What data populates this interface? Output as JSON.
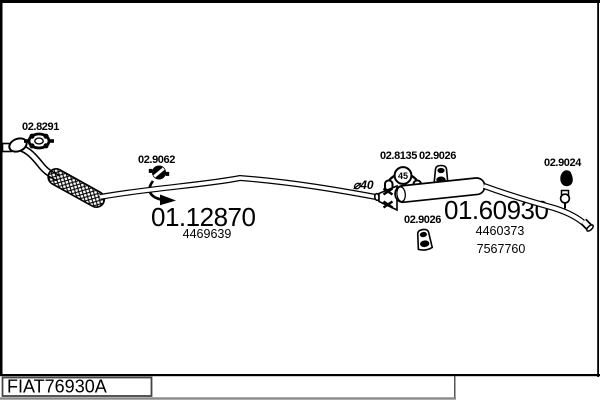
{
  "diagram": {
    "code": "FIAT76930A",
    "front_section": {
      "clamp_ref": "02.8291",
      "hanger_ref": "02.9062",
      "pipe_ref": "01.12870",
      "pipe_oem": "4469639"
    },
    "middle_section": {
      "diameter": "⌀40",
      "clamp_ref": "02.8135",
      "clamp_size": "45",
      "mount_upper_ref": "02.9026",
      "mount_lower_ref": "02.9026"
    },
    "rear_section": {
      "muffler_ref": "01.60930",
      "muffler_oem_1": "4460373",
      "muffler_oem_2": "7567760",
      "hanger_ref": "02.9024"
    }
  }
}
